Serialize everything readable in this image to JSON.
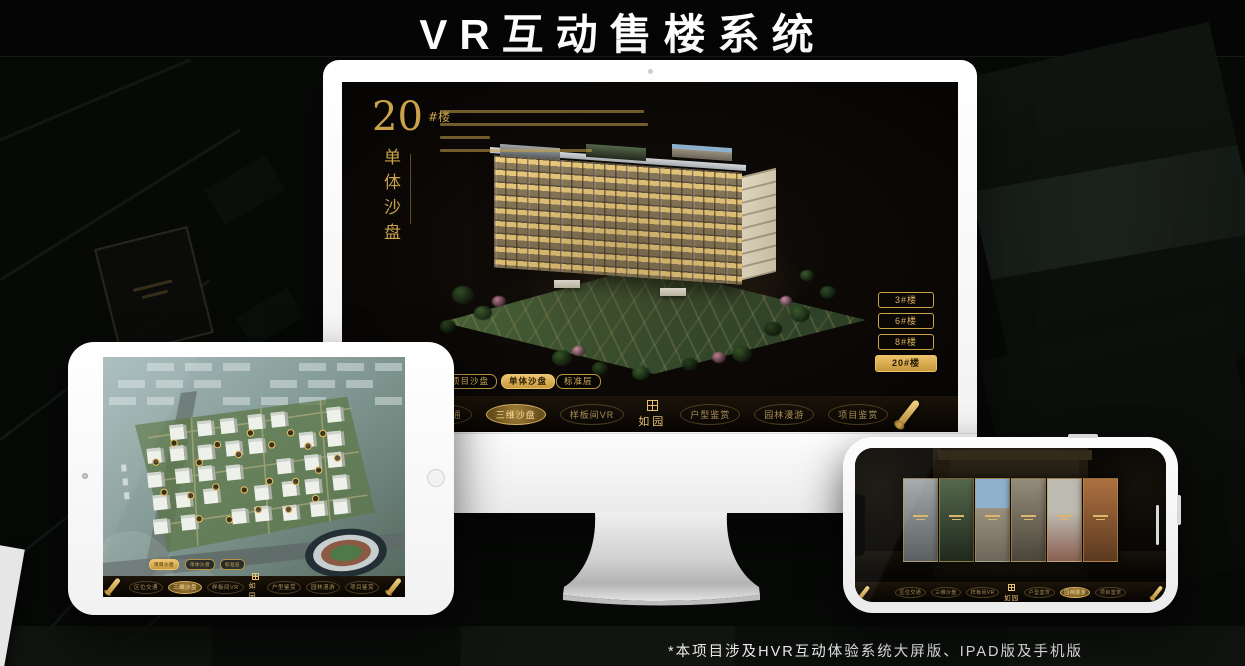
{
  "page": {
    "title": "VR互动售楼系统",
    "footnote": "*本项目涉及HVR互动体验系统大屏版、IPAD版及手机版"
  },
  "colors": {
    "accent_gold": "#c9a24b",
    "active_gold": "#e2b558",
    "screen_bg": "#0b0806"
  },
  "app": {
    "logo": "如园",
    "nav_items": [
      "区位交通",
      "三维沙盘",
      "样板间VR",
      "户型鉴赏",
      "园林漫游",
      "项目鉴赏"
    ],
    "sub_tabs": [
      "项目沙盘",
      "单体沙盘",
      "标准层"
    ]
  },
  "monitor": {
    "headline_number": "20",
    "headline_unit": "#楼",
    "headline_subtitle": "单体沙盘",
    "building_buttons": [
      "3#楼",
      "6#楼",
      "8#楼",
      "20#楼"
    ],
    "active_building": "20#楼",
    "active_sub_tab": "单体沙盘",
    "active_nav": "三维沙盘"
  },
  "tablet": {
    "active_sub_tab": "项目沙盘",
    "active_nav": "三维沙盘"
  },
  "phone": {
    "active_nav": "园林漫游"
  }
}
